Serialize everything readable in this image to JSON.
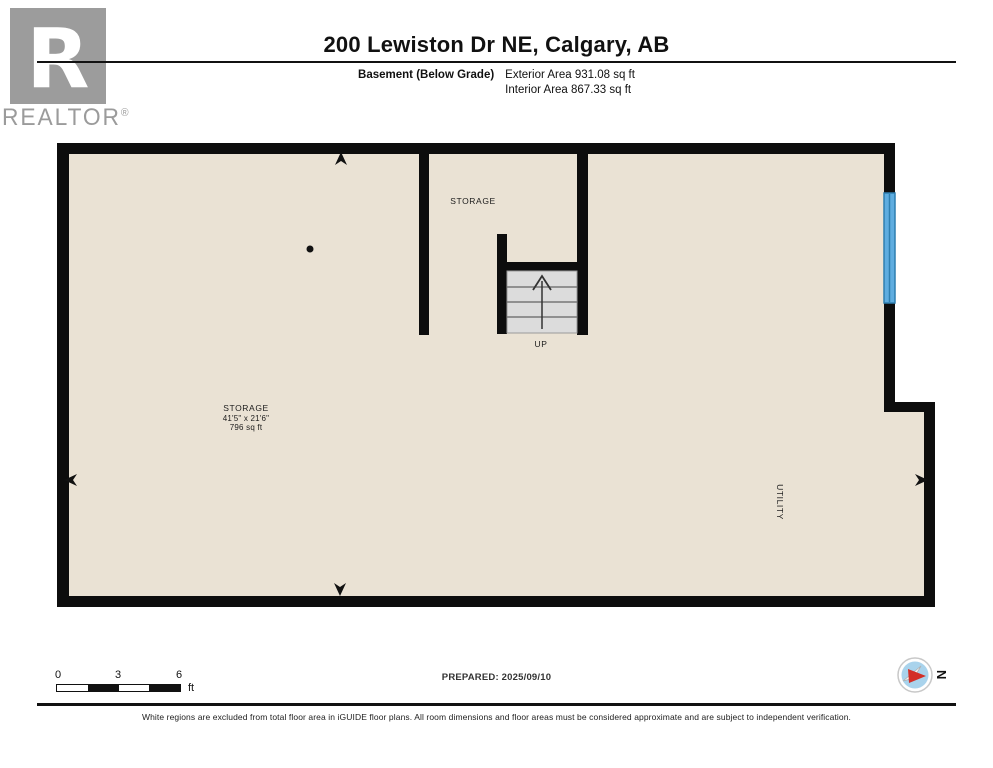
{
  "header": {
    "logo_text": "REALTOR",
    "logo_mark": "®",
    "logo_letter": "R",
    "title": "200 Lewiston Dr NE, Calgary, AB",
    "floor_label": "Basement (Below Grade)",
    "exterior_area": "Exterior Area 931.08 sq ft",
    "interior_area": "Interior Area 867.33 sq ft"
  },
  "plan": {
    "storage_top": {
      "label": "STORAGE"
    },
    "storage_main": {
      "label": "STORAGE",
      "dimensions": "41'5\" x 21'6\"",
      "area": "796 sq ft"
    },
    "utility": {
      "label": "UTILITY"
    },
    "stairs": {
      "label": "UP"
    },
    "colors": {
      "floor": "#eae2d4",
      "wall": "#0d0d0d",
      "window": "#5fade0",
      "window_frame": "#2f7fb0",
      "stair_fill": "#dcdcdc"
    }
  },
  "footer": {
    "scale": {
      "ticks": [
        "0",
        "3",
        "6"
      ],
      "unit": "ft"
    },
    "prepared": "PREPARED: 2025/09/10",
    "compass_north": "N",
    "disclaimer": "White regions are excluded from total floor area in iGUIDE floor plans. All room dimensions and floor areas must be considered approximate and are subject to independent verification."
  }
}
